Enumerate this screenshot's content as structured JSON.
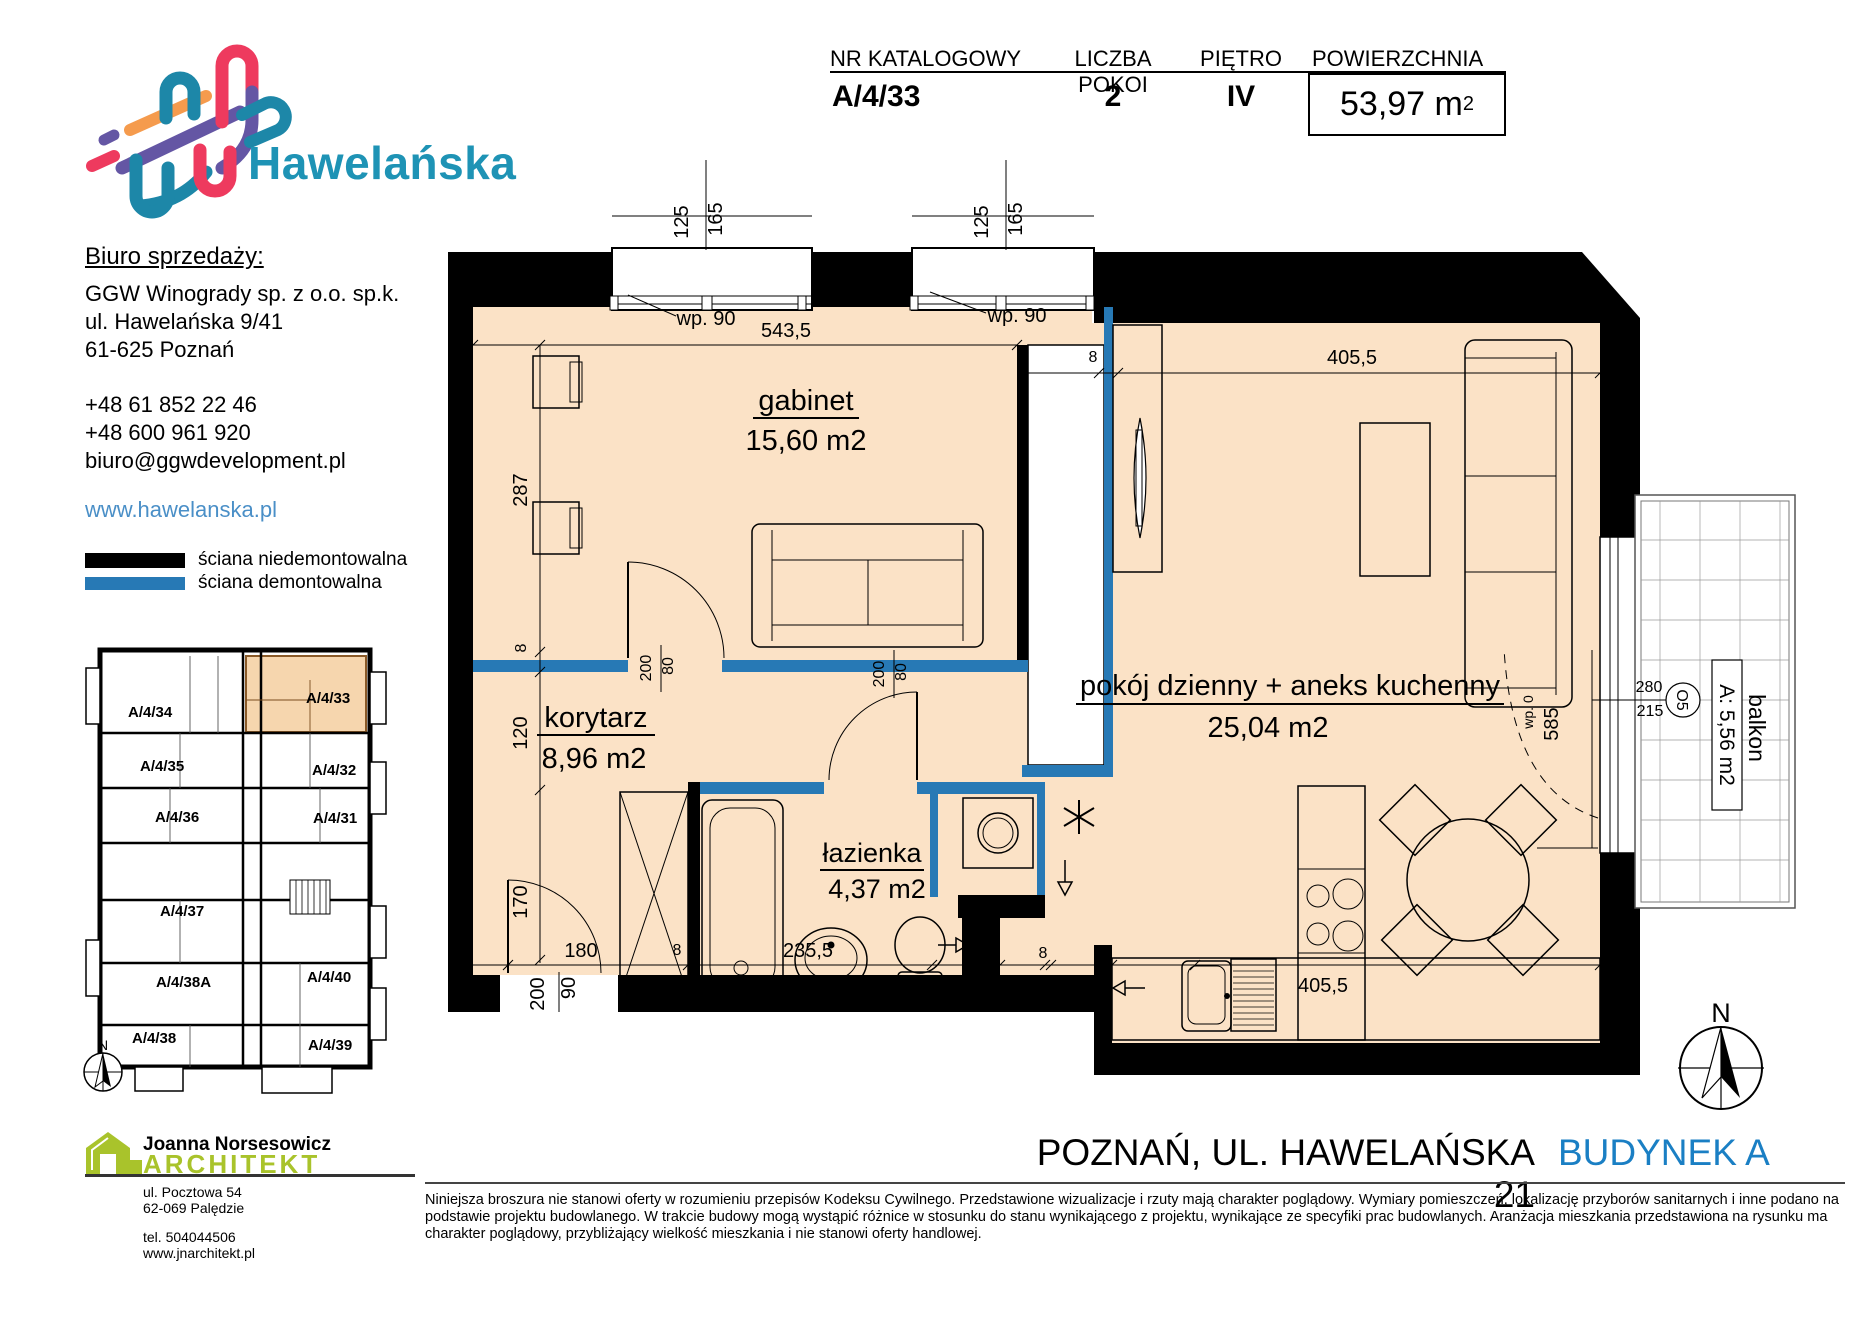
{
  "brand": "Hawelańska",
  "header": {
    "col_catalog": "NR KATALOGOWY",
    "col_rooms": "LICZBA POKOI",
    "col_floor": "PIĘTRO",
    "col_area": "POWIERZCHNIA",
    "catalog": "A/4/33",
    "rooms": "2",
    "floor": "IV",
    "area_value": "53,97 m",
    "area_sup": "2"
  },
  "office": {
    "heading": "Biuro sprzedaży:",
    "company": "GGW Winogrady sp. z o.o. sp.k.",
    "street": "ul. Hawelańska 9/41",
    "city": "61-625 Poznań",
    "phone1": "+48 61 852 22 46",
    "phone2": "+48 600 961 920",
    "email": "biuro@ggwdevelopment.pl",
    "website": "www.hawelanska.pl"
  },
  "legend": {
    "solid": "ściana niedemontowalna",
    "demountable": "ściana demontowalna"
  },
  "mini_plan": {
    "north": "N",
    "units": {
      "u34": "A/4/34",
      "u33": "A/4/33",
      "u35": "A/4/35",
      "u32": "A/4/32",
      "u36": "A/4/36",
      "u31": "A/4/31",
      "u37": "A/4/37",
      "u38a": "A/4/38A",
      "u40": "A/4/40",
      "u38": "A/4/38",
      "u39": "A/4/39"
    }
  },
  "plan": {
    "rooms": {
      "gabinet": {
        "name": "gabinet",
        "area": "15,60 m2"
      },
      "living": {
        "name": "pokój dzienny + aneks kuchenny",
        "area": "25,04 m2"
      },
      "korytarz": {
        "name": "korytarz",
        "area": "8,96 m2"
      },
      "lazienka": {
        "name": "łazienka",
        "area": "4,37 m2"
      },
      "balkon": {
        "name": "balkon",
        "area": "A: 5,56 m2",
        "tag": "O5",
        "width": "280",
        "depth": "215"
      }
    },
    "dims": {
      "d125": "125",
      "d165": "165",
      "wp90": "wp. 90",
      "d5435": "543,5",
      "d8": "8",
      "d4055": "405,5",
      "d287": "287",
      "d120": "120",
      "d170": "170",
      "d80": "80",
      "d200": "200",
      "d180": "180",
      "d2355": "235,5",
      "d60": "60",
      "d90": "90",
      "d585": "585",
      "wp0": "wp. 0"
    },
    "north": "N"
  },
  "architect": {
    "name": "Joanna Norsesowicz",
    "title": "ARCHITEKT",
    "street": "ul. Pocztowa 54",
    "city": "62-069 Palędzie",
    "phone": "tel. 504044506",
    "website": "www.jnarchitekt.pl"
  },
  "footer": {
    "address": "POZNAŃ, UL. HAWELAŃSKA 21",
    "building": "BUDYNEK A",
    "disclaimer": "Niniejsza broszura nie stanowi oferty w rozumieniu przepisów Kodeksu Cywilnego. Przedstawione wizualizacje i rzuty mają charakter poglądowy. Wymiary pomieszczeń, lokalizację przyborów sanitarnych i inne podano na podstawie projektu budowlanego. W trakcie budowy mogą wystąpić różnice w stosunku do stanu wynikającego z projektu, wynikające ze specyfiki prac budowlanych. Aranżacja mieszkania przedstawiona na rysunku ma charakter poglądowy, przybliżający wielkość mieszkania i nie stanowi oferty handlowej."
  },
  "colors": {
    "wall_blue": "#2779b5",
    "accent_blue": "#1a7fc4",
    "brand_teal": "#1e93b5",
    "link_blue": "#4a8fc7",
    "architect_green": "#a9c32b",
    "floor_fill": "#fbe2c6",
    "highlight_fill": "#f6d6ae"
  }
}
